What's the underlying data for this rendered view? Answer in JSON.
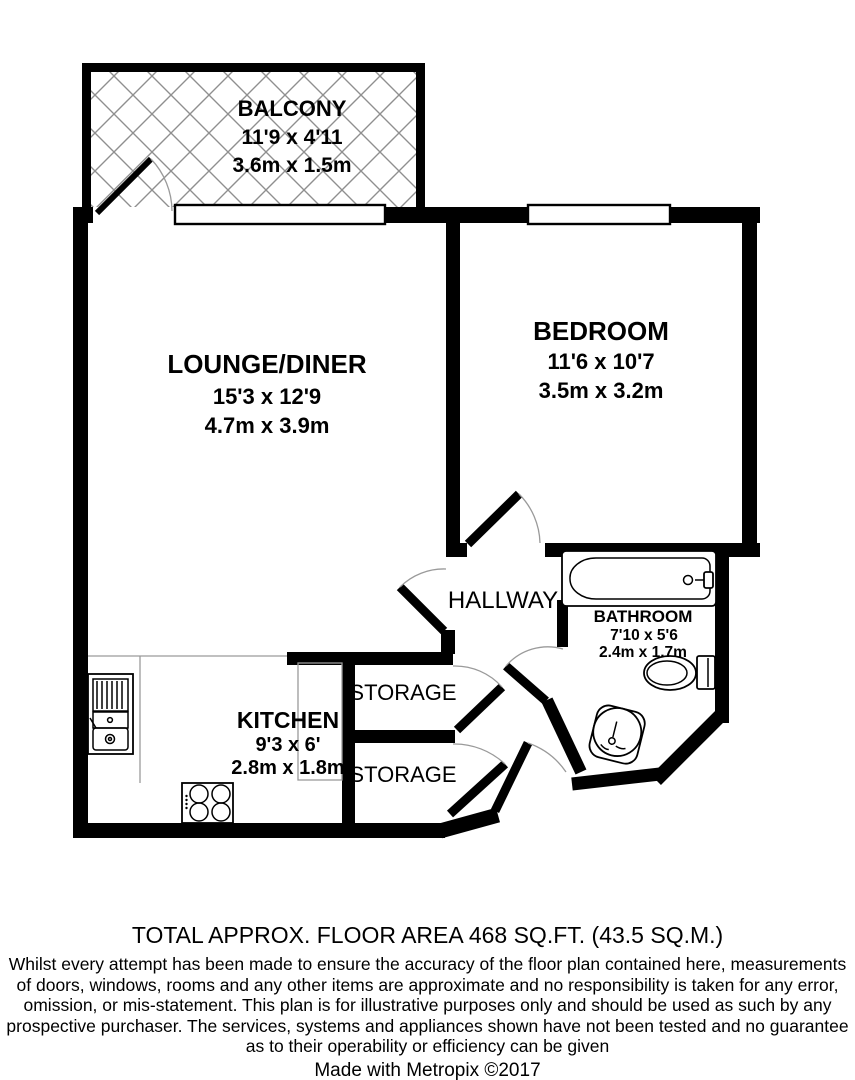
{
  "floorplan": {
    "balcony": {
      "name": "BALCONY",
      "imperial": "11'9 x 4'11",
      "metric": "3.6m x 1.5m"
    },
    "lounge_diner": {
      "name": "LOUNGE/DINER",
      "imperial": "15'3 x 12'9",
      "metric": "4.7m x 3.9m"
    },
    "bedroom": {
      "name": "BEDROOM",
      "imperial": "11'6 x 10'7",
      "metric": "3.5m x 3.2m"
    },
    "hallway": {
      "name": "HALLWAY"
    },
    "bathroom": {
      "name": "BATHROOM",
      "imperial": "7'10 x 5'6",
      "metric": "2.4m x 1.7m"
    },
    "kitchen": {
      "name": "KITCHEN",
      "imperial": "9'3 x 6'",
      "metric": "2.8m x 1.8m"
    },
    "storage_top": {
      "name": "STORAGE"
    },
    "storage_bottom": {
      "name": "STORAGE"
    },
    "colors": {
      "wall": "#000000",
      "hatch_line": "#8f8f8f",
      "door_arc": "#9a9a9a",
      "counter_line": "#9a9a9a"
    }
  },
  "footer": {
    "total_area": "TOTAL APPROX. FLOOR AREA 468 SQ.FT. (43.5 SQ.M.)",
    "disclaimer": [
      "Whilst every attempt has been made to ensure the accuracy of the floor plan contained here, measurements",
      "of doors, windows, rooms and any other items are approximate and no responsibility is taken for any error,",
      "omission, or mis-statement. This plan is for illustrative purposes only and should be used as such by any",
      "prospective purchaser. The services, systems and appliances shown have not been tested and no guarantee",
      "as to their operability or efficiency can be given"
    ],
    "credit": "Made with Metropix ©2017"
  }
}
